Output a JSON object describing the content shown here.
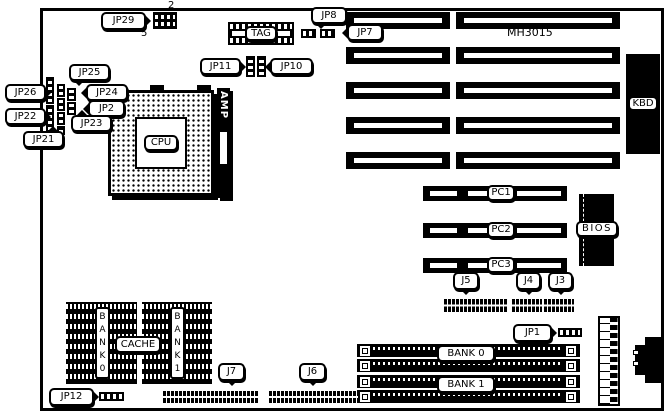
{
  "diagram": {
    "chipset_label": "MH3015",
    "cpu_label": "CPU",
    "amp_label": "AMP",
    "tag_label": "TAG",
    "kbd_label": "KBD",
    "bios_label": "BIOS",
    "cache_label": "CACHE",
    "cache_bank0_label": "BANK0",
    "cache_bank1_label": "BANK1",
    "simm_bank0_label": "BANK 0",
    "simm_bank1_label": "BANK 1",
    "pci_slots": [
      "PC1",
      "PC2",
      "PC3"
    ],
    "jumpers": {
      "jp1": "JP1",
      "jp2": "JP2",
      "jp7": "JP7",
      "jp8": "JP8",
      "jp10": "JP10",
      "jp11": "JP11",
      "jp12": "JP12",
      "jp21": "JP21",
      "jp22": "JP22",
      "jp23": "JP23",
      "jp24": "JP24",
      "jp25": "JP25",
      "jp26": "JP26",
      "jp29": "JP29"
    },
    "headers": {
      "j3": "J3",
      "j4": "J4",
      "j5": "J5",
      "j6": "J6",
      "j7": "J7"
    },
    "pin_annotations": {
      "jp29_pin2": "2",
      "jp29_pin5": "5"
    }
  }
}
